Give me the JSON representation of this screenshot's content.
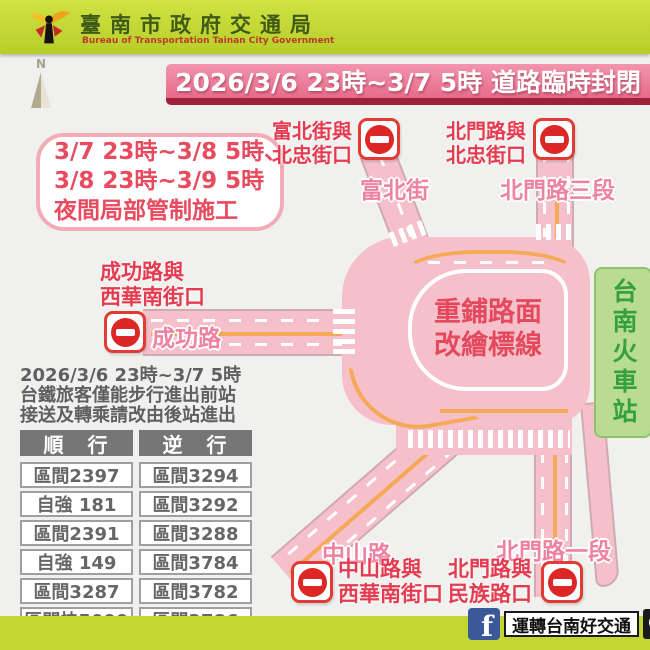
{
  "header": {
    "agency_zh": "臺南市政府交通局",
    "agency_en": "Bureau of Transportation Tainan City Government"
  },
  "compass": {
    "label": "N"
  },
  "banner": {
    "title": "2026/3/6 23時~3/7 5時 道路臨時封閉"
  },
  "notice": {
    "line1": "3/7 23時~3/8 5時、",
    "line2": "3/8 23時~3/9 5時",
    "line3": "夜間局部管制施工"
  },
  "map": {
    "center_line1": "重鋪路面",
    "center_line2": "改繪標線",
    "station": "台南火車站",
    "roads": {
      "fubei": "富北街",
      "beimen3": "北門路三段",
      "chenggong": "成功路",
      "zhongshan": "中山路",
      "beimen1": "北門路一段"
    },
    "closures": {
      "fubei": {
        "line1": "富北街與",
        "line2": "北忠街口"
      },
      "beimen_north": {
        "line1": "北門路與",
        "line2": "北忠街口"
      },
      "chenggong": {
        "line1": "成功路與",
        "line2": "西華南街口"
      },
      "zhongshan": {
        "line1": "中山路與",
        "line2": "西華南街口"
      },
      "beimen_south": {
        "line1": "北門路與",
        "line2": "民族路口"
      }
    }
  },
  "rail_notice": {
    "line1": "2026/3/6 23時~3/7 5時",
    "line2": "台鐵旅客僅能步行進出前站",
    "line3": "接送及轉乘請改由後站進出",
    "table": {
      "col1": "順　行",
      "col2": "逆　行",
      "rows": [
        [
          "區間2397",
          "區間3294"
        ],
        [
          "自強 181",
          "區間3292"
        ],
        [
          "區間2391",
          "區間3288"
        ],
        [
          "自強 149",
          "區間3784"
        ],
        [
          "區間3287",
          "區間3782"
        ],
        [
          "區間快5099",
          "區間3786"
        ]
      ]
    }
  },
  "footer": {
    "facebook_f": "f",
    "page_name": "運轉台南好交通"
  },
  "colors": {
    "header_green": "#c1d633",
    "banner_pink": "#e76b8b",
    "banner_shadow": "#9c2139",
    "road_pink": "#f6c0cb",
    "lane_orange": "#f5a855",
    "closure_red": "#e53b50",
    "road_label_pink": "#ee82a2",
    "station_green": "#b9dc92",
    "sign_red": "#dd2726",
    "facebook_blue": "#3b5998"
  }
}
